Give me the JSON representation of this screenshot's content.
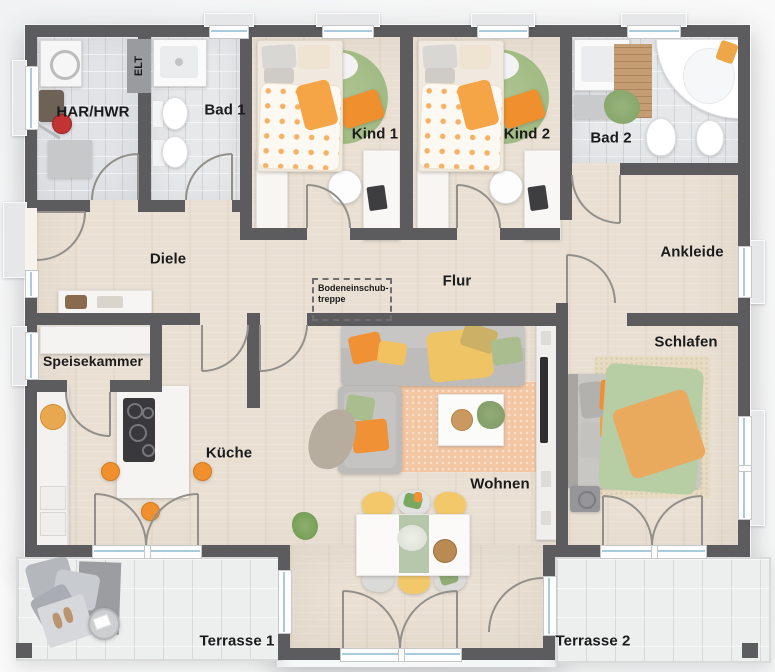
{
  "rooms": {
    "har_hwr": {
      "label": "HAR/HWR"
    },
    "elt": {
      "label": "ELT"
    },
    "bad1": {
      "label": "Bad 1"
    },
    "kind1": {
      "label": "Kind 1"
    },
    "kind2": {
      "label": "Kind 2"
    },
    "bad2": {
      "label": "Bad 2"
    },
    "diele": {
      "label": "Diele"
    },
    "flur": {
      "label": "Flur"
    },
    "ankleide": {
      "label": "Ankleide"
    },
    "speisekammer": {
      "label": "Speisekammer"
    },
    "schlafen": {
      "label": "Schlafen"
    },
    "kueche": {
      "label": "Küche"
    },
    "wohnen": {
      "label": "Wohnen"
    },
    "terrasse1": {
      "label": "Terrasse 1"
    },
    "terrasse2": {
      "label": "Terrasse 2"
    }
  },
  "annotations": {
    "loft_stairs": {
      "line1": "Bodeneinschub-",
      "line2": "treppe"
    }
  },
  "colors": {
    "wall": "#5c5c5e",
    "wood": "#e9e0d3",
    "tile": "#e7e8ea",
    "terrace": "#edeeee",
    "accent": "#ef8f2d",
    "sage": "#a9c08f",
    "glass": "#a9cbdc",
    "label": "#1b1b1d"
  }
}
